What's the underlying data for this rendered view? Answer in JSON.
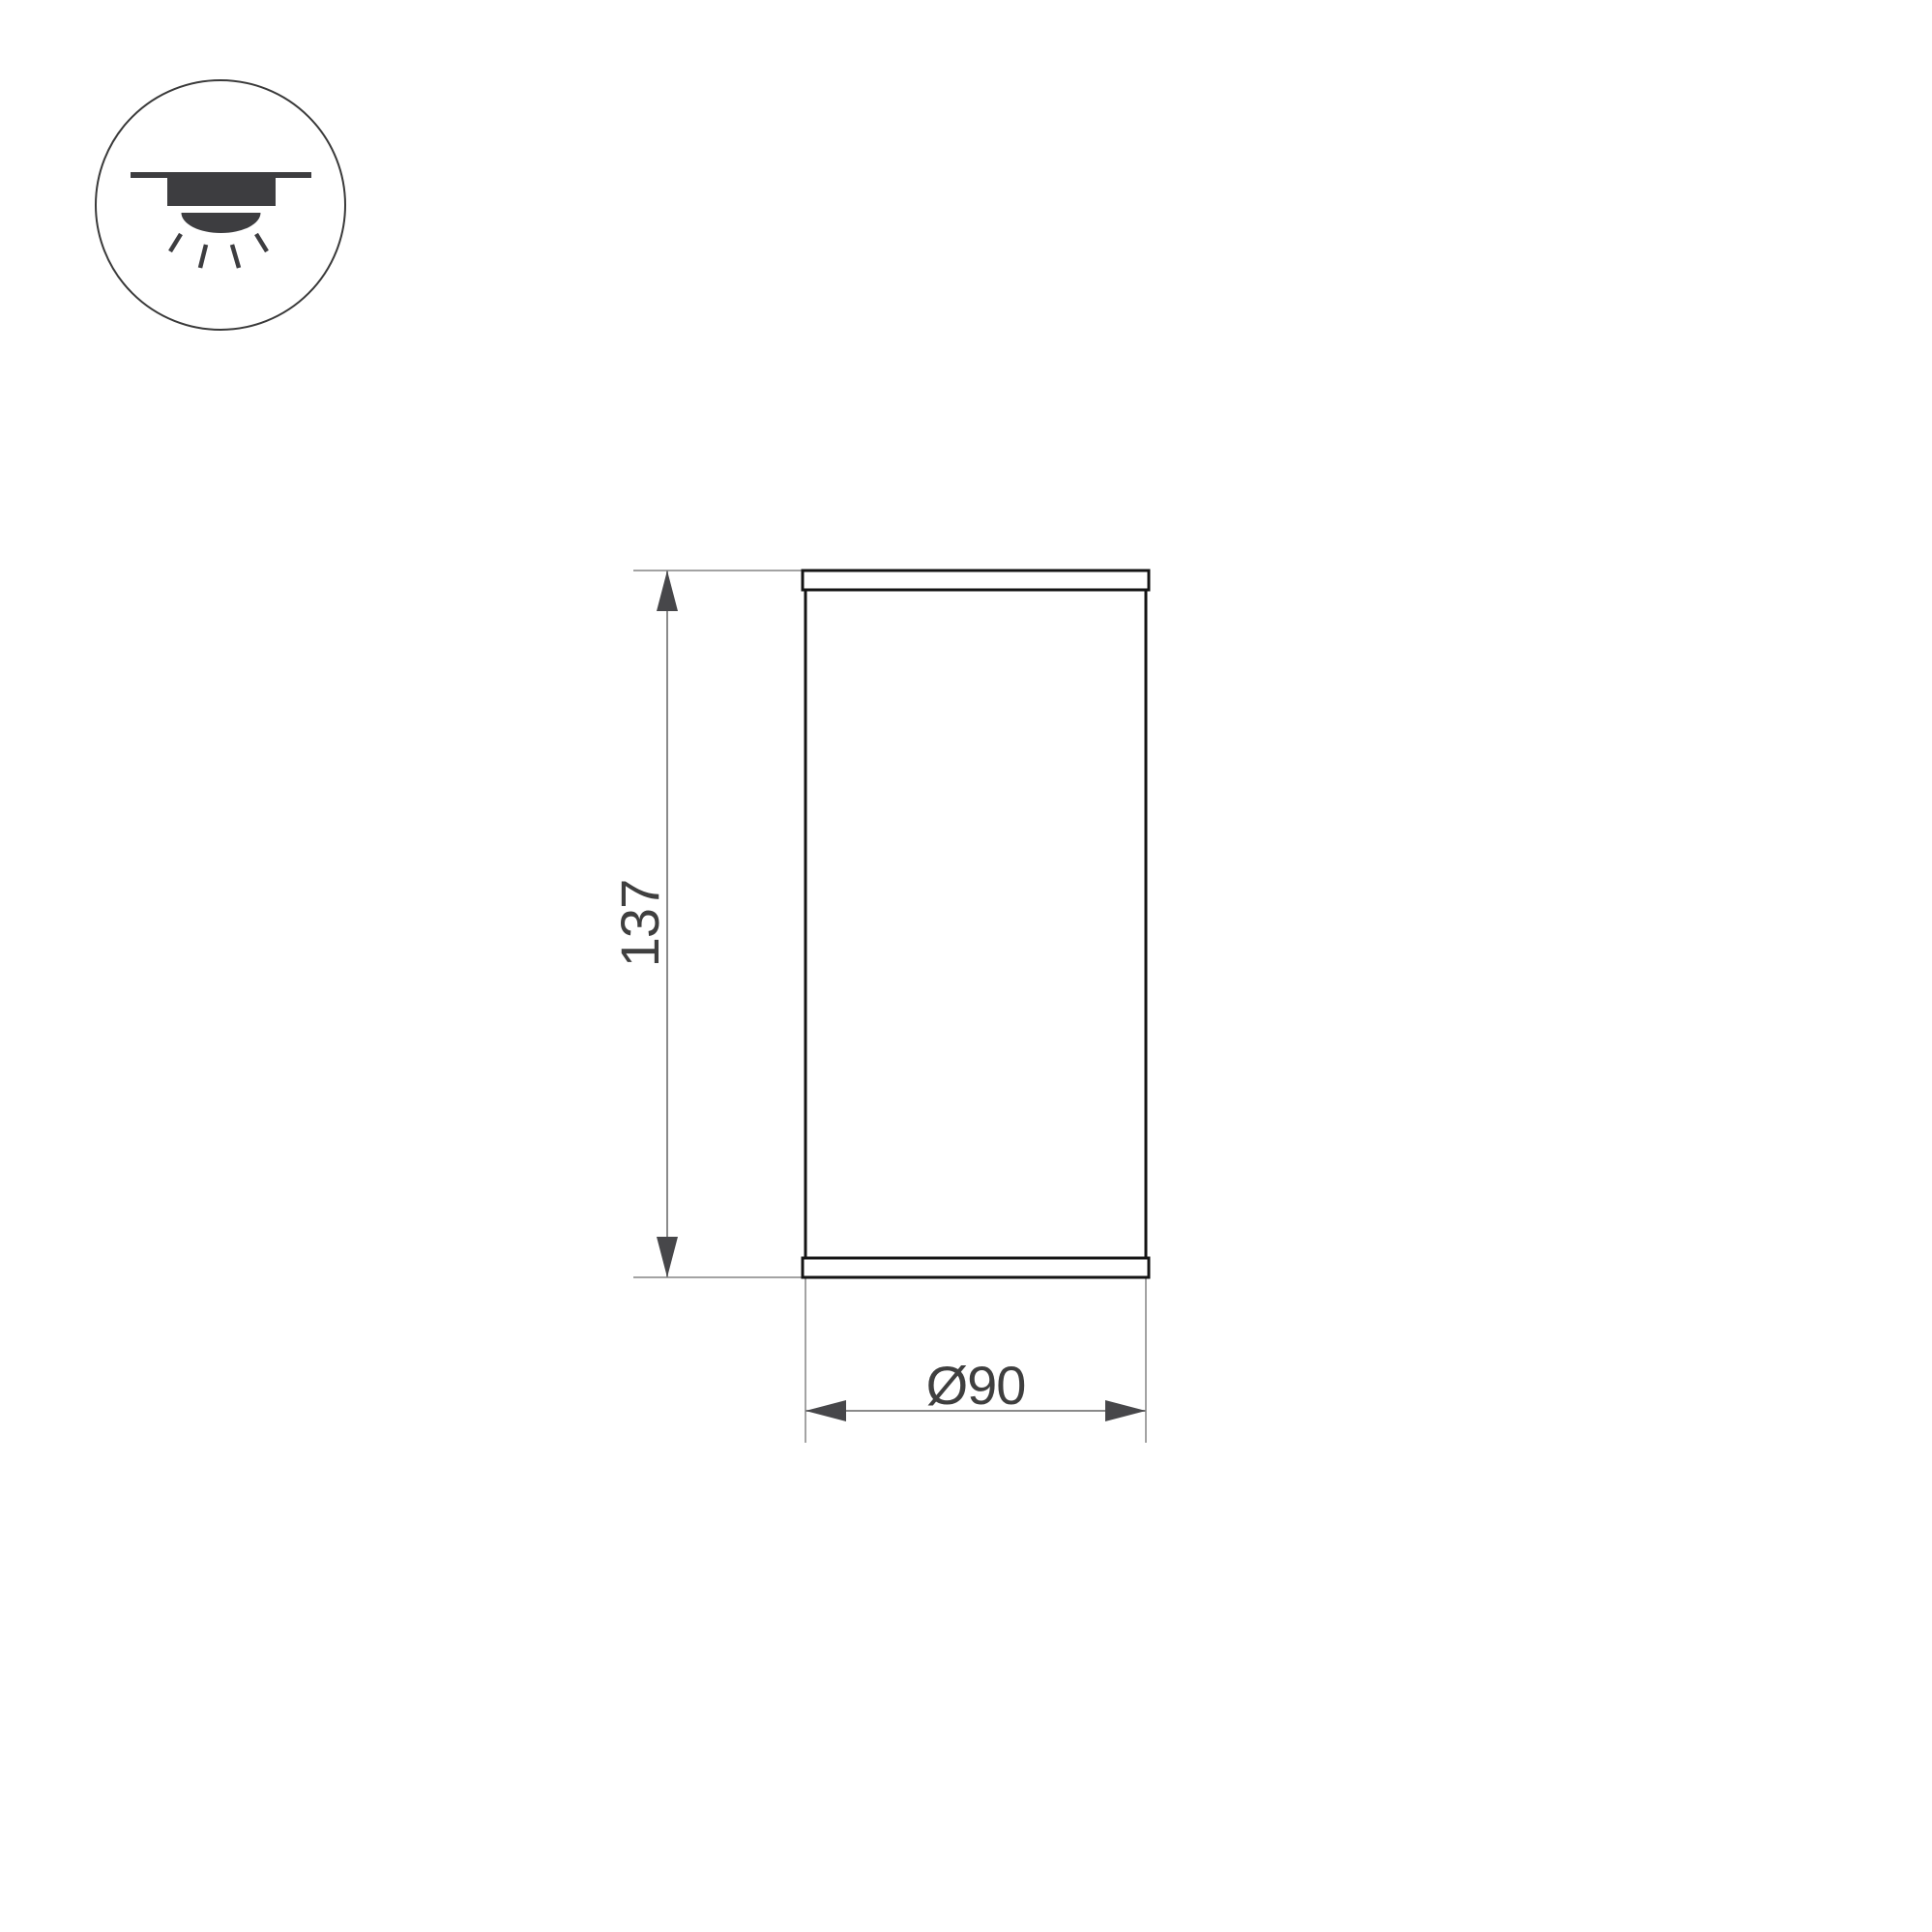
{
  "page": {
    "title": "Luminaire dimension drawing",
    "background": "#ffffff"
  },
  "colors": {
    "outline": "#141414",
    "extline": "#a3a3a3",
    "dimline": "#8a8a8a",
    "arrow": "#47474a",
    "text": "#3f3f3f",
    "icon": "#3d3d40",
    "iconstroke": "#3a3a3a",
    "bg": "#ffffff"
  },
  "icon": {
    "name": "surface-mounted-downlight"
  },
  "drawing": {
    "view": "front-elevation",
    "dimensions": {
      "height": {
        "label": "137",
        "value": 137,
        "axis": "vertical"
      },
      "diameter": {
        "label": "Ø90",
        "value": 90,
        "axis": "horizontal"
      }
    }
  }
}
